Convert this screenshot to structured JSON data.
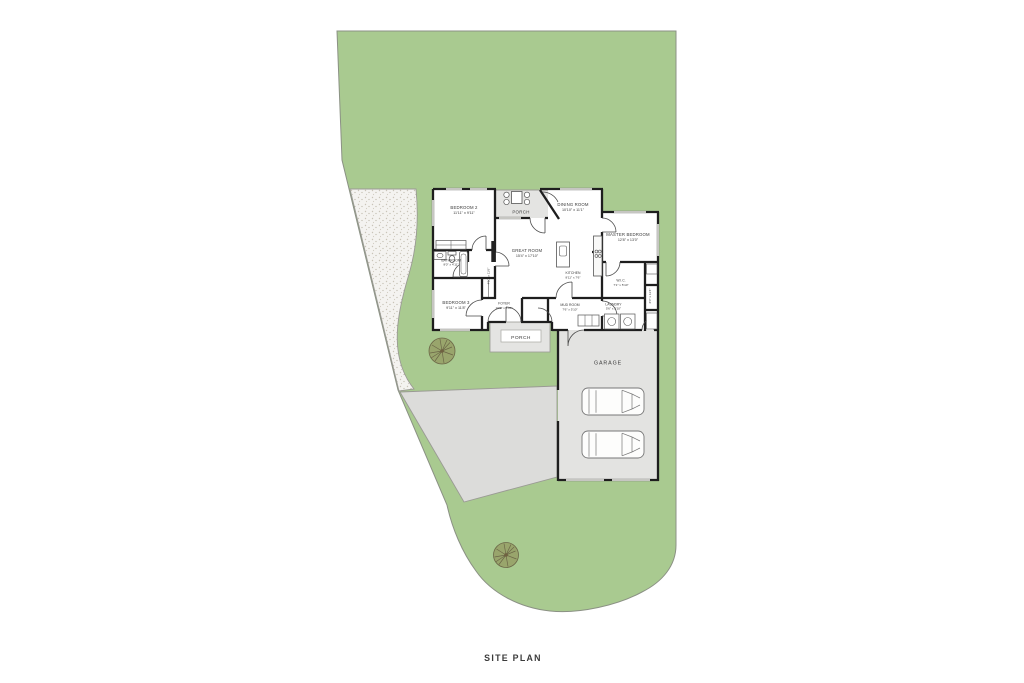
{
  "title": "SITE PLAN",
  "colors": {
    "lawn": "#a9ca90",
    "site_border": "#8b9184",
    "gravel": "#f4f3f0",
    "gravel_dot": "#c7c2b6",
    "driveway": "#dcdcda",
    "porch": "#e4e4e2",
    "garage_floor": "#e3e3e1",
    "wall": "#1e1e1e",
    "window": "#c6c6c2",
    "door": "#4a4a4a",
    "fixture": "#555555",
    "tree_fill": "#99a56c",
    "tree_line": "#6b6647",
    "label": "#3a3a3a"
  },
  "rooms": {
    "porch_top": {
      "name": "PORCH"
    },
    "bedroom2": {
      "name": "BEDROOM 2",
      "dims": "11'11\" x 9'11\""
    },
    "dining": {
      "name": "DINING ROOM",
      "dims": "10'10\" x 11'1\""
    },
    "master": {
      "name": "MASTER BEDROOM",
      "dims": "12'8\" x 13'0\""
    },
    "great": {
      "name": "GREAT ROOM",
      "dims": "15'4\" x 17'10\""
    },
    "kitchen": {
      "name": "KITCHEN",
      "dims": "8'11\" x 7'6\""
    },
    "bathroom": {
      "name": "BATHROOM",
      "dims": "8'0\" x 4'11\""
    },
    "hall": {
      "dims": "4'10\" x 11'6\""
    },
    "bedroom3": {
      "name": "BEDROOM 3",
      "dims": "9'11\" x 11'8\""
    },
    "foyer": {
      "name": "FOYER",
      "dims": "10'6\" x 5'10\""
    },
    "mudroom": {
      "name": "MUD ROOM",
      "dims": "7'6\" x 5'10\""
    },
    "laundry": {
      "name": "LAUNDRY",
      "dims": "5'6\" x 5'10\""
    },
    "wic": {
      "name": "W.I.C.",
      "dims": "7'1\" x 5'10\""
    },
    "closet": {
      "dims": "2'0\" x 11'4\""
    },
    "porch_bottom": {
      "name": "PORCH"
    },
    "garage": {
      "name": "GARAGE"
    }
  }
}
